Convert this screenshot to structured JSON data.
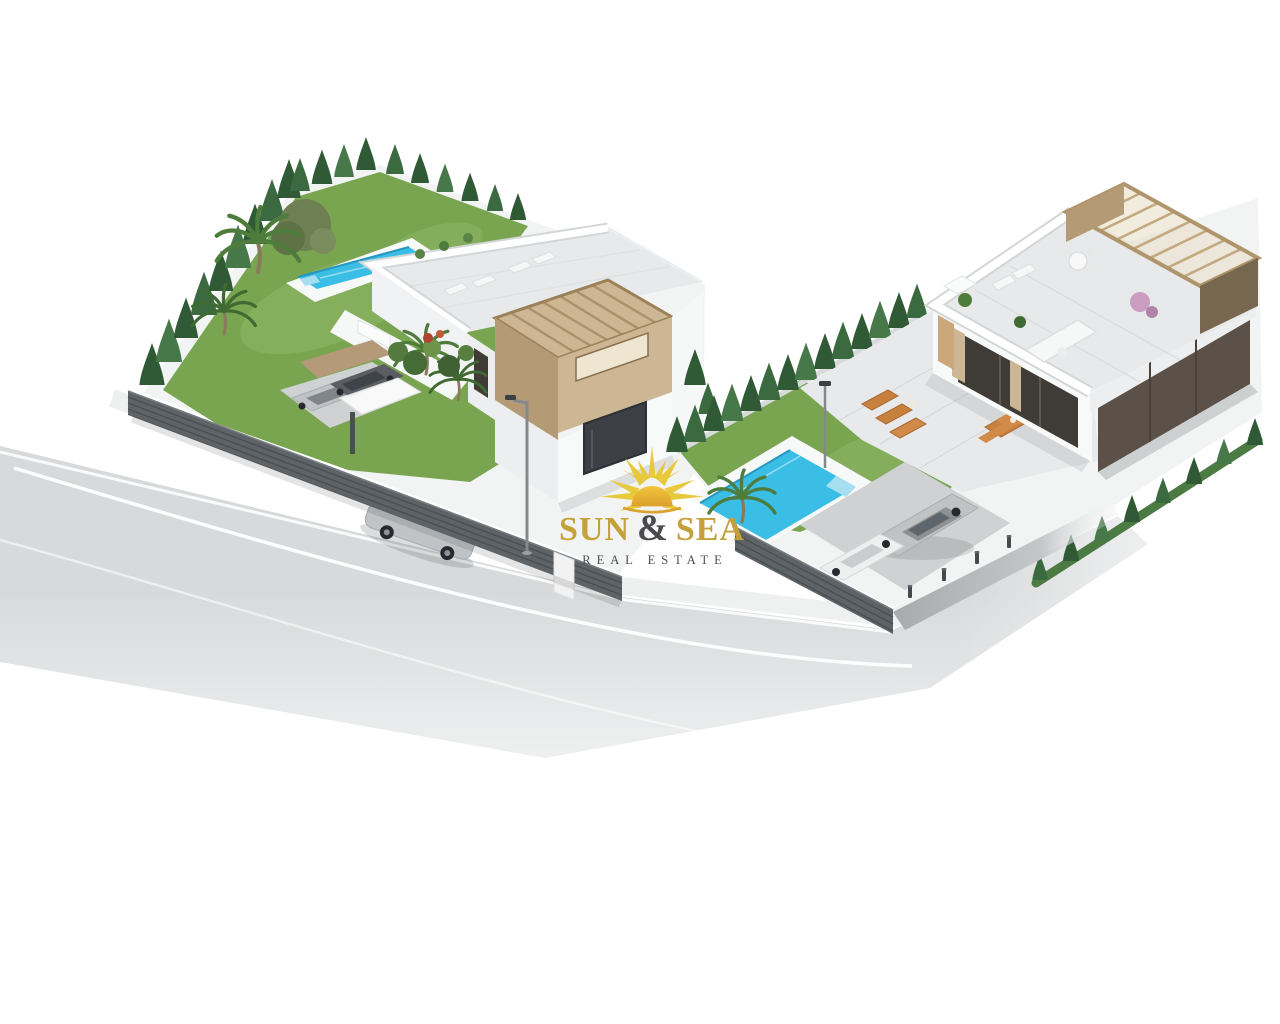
{
  "watermark": {
    "word_sun": "SUN",
    "ampersand": "&",
    "word_sea": "SEA",
    "tagline": "REAL ESTATE",
    "logo_icon": "sun-rays-icon",
    "colors": {
      "gold": "#C4A13A",
      "ray": "#E8C93B",
      "ray_dark": "#D9B02E",
      "core_top": "#F2C63D",
      "core_bottom": "#DD9F2C",
      "charcoal": "#4B4B4D"
    }
  },
  "scene": {
    "colors": {
      "background": "#FFFFFF",
      "lawn": "#79A551",
      "lawn_light": "#9FC273",
      "pool_water": "#3BBEE6",
      "pool_step": "#A6E0F0",
      "pool_deck": "#F7F8F8",
      "cypress_dark": "#2F5A35",
      "cypress_light": "#47784A",
      "hedge_low": "#4C7A43",
      "olive": "#6E8052",
      "palm": "#4E7C3C",
      "shrub": "#456B36",
      "flower_red": "#B0452F",
      "fence": "#5D6367",
      "fence_slat": "#495054",
      "wall": "#F8F9F9",
      "wall_shade": "#ECEEEF",
      "terrace_floor": "#E7E9EA",
      "paving": "#F2F3F3",
      "pergola": "#CDB694",
      "pergola_shade": "#B59A76",
      "pergola_dark": "#77674F",
      "brown_wall": "#5B5148",
      "window_dark": "#3C4046",
      "porch_glass": "#3F3B37",
      "wood_door": "#CAA87C",
      "road": "#D7D9DA",
      "sidewalk": "#EEEFEF",
      "road_line": "#FFFFFF",
      "street_strip": "#A7ABAD",
      "driveway": "#CFD1D2",
      "car_silver": "#BFC3C6",
      "car_dark": "#5A5E62",
      "car_white": "#EEF0F0",
      "wheel": "#26292D",
      "wood_furniture": "#C8803F",
      "white_furniture": "#F6F7F7",
      "bougainvillea": "#C695BD",
      "trunk": "#8A7A5C"
    }
  }
}
